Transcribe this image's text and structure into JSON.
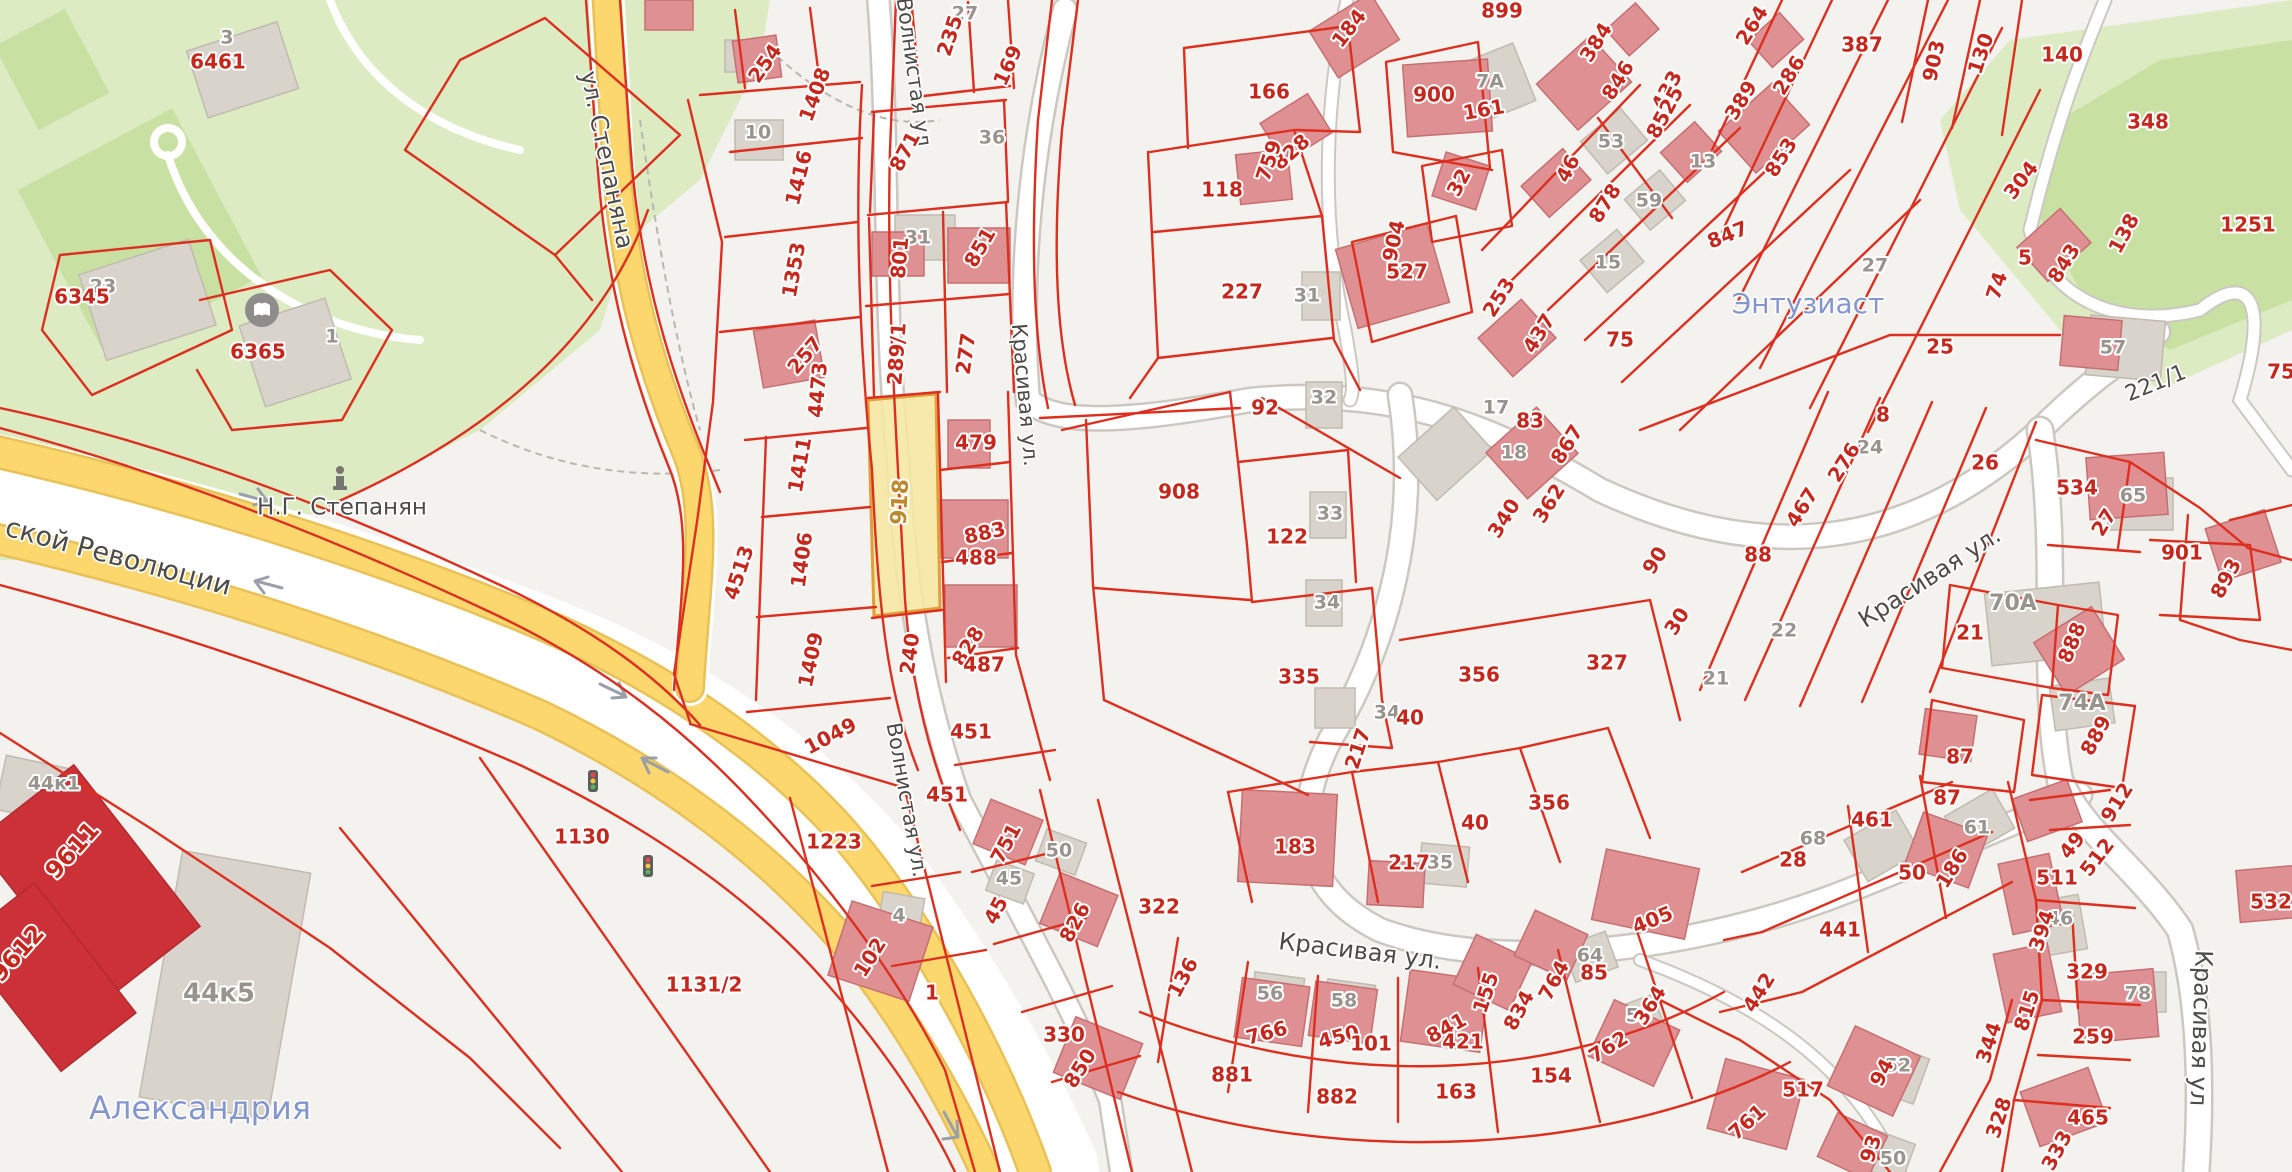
{
  "map": {
    "selected_parcel": {
      "label": "918",
      "x": 901,
      "y": 502,
      "r": -87
    },
    "colors": {
      "parcel_line": "#dd2f1f",
      "parcel_text": "#c6271d",
      "selected_fill": "#f6e7a2",
      "selected_border": "#df9f3c",
      "selected_text": "#bd8a2e",
      "road_yellow": "#fbd76e",
      "park_green": "#dcebc2",
      "building_rose": "#de9093",
      "building_gray": "#d9d4cb",
      "place_text": "#8496cd"
    },
    "street_labels": [
      [
        "ул. Степаняна",
        606,
        160,
        78,
        24
      ],
      [
        "ской Революции",
        118,
        558,
        15,
        27
      ],
      [
        "Волнистая ул",
        913,
        72,
        82,
        21
      ],
      [
        "Волнистая ул.",
        906,
        800,
        80,
        21
      ],
      [
        "Красивая ул.",
        1024,
        395,
        85,
        21
      ],
      [
        "Красивая ул.",
        1930,
        578,
        -33,
        24
      ],
      [
        "Красивая ул.",
        1360,
        952,
        7,
        24
      ],
      [
        "Красивая ул",
        2200,
        1028,
        92,
        24
      ],
      [
        "221/1",
        2156,
        384,
        -22,
        22
      ],
      [
        "Н.Г. Степанян",
        342,
        508,
        0,
        23
      ]
    ],
    "place_labels": [
      [
        "Александрия",
        200,
        1110,
        0,
        32
      ],
      [
        "Энтузиаст",
        1808,
        305,
        0,
        28
      ]
    ],
    "parcel_labels": [
      [
        "6461",
        218,
        63
      ],
      [
        "6345",
        82,
        298
      ],
      [
        "6365",
        258,
        353
      ],
      [
        "254",
        766,
        64,
        -55
      ],
      [
        "1408",
        816,
        95,
        -70
      ],
      [
        "1416",
        800,
        178,
        -76
      ],
      [
        "1353",
        795,
        270,
        -80
      ],
      [
        "257",
        806,
        356,
        -50
      ],
      [
        "4473",
        819,
        390,
        -85
      ],
      [
        "1411",
        801,
        465,
        -80
      ],
      [
        "1406",
        803,
        560,
        -82
      ],
      [
        "4513",
        740,
        573,
        -72
      ],
      [
        "1409",
        812,
        660,
        -78
      ],
      [
        "1049",
        831,
        737,
        -28
      ],
      [
        "871",
        906,
        152,
        -62
      ],
      [
        "235",
        951,
        36,
        -72
      ],
      [
        "169",
        1009,
        66,
        -66
      ],
      [
        "801",
        901,
        258,
        -85
      ],
      [
        "851",
        981,
        248,
        -60
      ],
      [
        "289/1",
        898,
        354,
        -86
      ],
      [
        "277",
        967,
        354,
        -82
      ],
      [
        "479",
        976,
        444
      ],
      [
        "883",
        985,
        534,
        -12
      ],
      [
        "488",
        976,
        559
      ],
      [
        "828",
        969,
        647,
        -58
      ],
      [
        "487",
        984,
        666
      ],
      [
        "240",
        911,
        654,
        -82
      ],
      [
        "451",
        971,
        733
      ],
      [
        "451",
        947,
        796
      ],
      [
        "1130",
        582,
        838
      ],
      [
        "1131/2",
        704,
        986
      ],
      [
        "1223",
        834,
        843
      ],
      [
        "102",
        871,
        958,
        -58
      ],
      [
        "1",
        932,
        994
      ],
      [
        "9611",
        73,
        851,
        -48,
        24
      ],
      [
        "9612",
        18,
        954,
        -48,
        24
      ],
      [
        "751",
        1007,
        844,
        -62
      ],
      [
        "45",
        997,
        911,
        -62
      ],
      [
        "826",
        1076,
        923,
        -62
      ],
      [
        "330",
        1064,
        1036
      ],
      [
        "850",
        1081,
        1069,
        -58
      ],
      [
        "322",
        1159,
        908
      ],
      [
        "136",
        1184,
        978,
        -62
      ],
      [
        "766",
        1267,
        1034,
        -15
      ],
      [
        "450",
        1339,
        1038,
        -15
      ],
      [
        "101",
        1371,
        1045
      ],
      [
        "841",
        1447,
        1029,
        -28
      ],
      [
        "421",
        1463,
        1043
      ],
      [
        "155",
        1487,
        993,
        -72
      ],
      [
        "834",
        1520,
        1011,
        -62
      ],
      [
        "764",
        1555,
        981,
        -62
      ],
      [
        "85",
        1594,
        974
      ],
      [
        "405",
        1653,
        921,
        -22
      ],
      [
        "364",
        1651,
        1006,
        -58
      ],
      [
        "762",
        1609,
        1048,
        -32
      ],
      [
        "154",
        1551,
        1077
      ],
      [
        "163",
        1456,
        1093
      ],
      [
        "881",
        1232,
        1076
      ],
      [
        "882",
        1337,
        1098
      ],
      [
        "183",
        1295,
        848
      ],
      [
        "217",
        1409,
        864
      ],
      [
        "217",
        1359,
        749,
        -72
      ],
      [
        "40",
        1410,
        719
      ],
      [
        "40",
        1475,
        824
      ],
      [
        "356",
        1479,
        676
      ],
      [
        "356",
        1549,
        804
      ],
      [
        "335",
        1299,
        678
      ],
      [
        "122",
        1287,
        538
      ],
      [
        "92",
        1265,
        409
      ],
      [
        "908",
        1179,
        493
      ],
      [
        "227",
        1242,
        293
      ],
      [
        "118",
        1222,
        191
      ],
      [
        "166",
        1269,
        93
      ],
      [
        "899",
        1502,
        12
      ],
      [
        "184",
        1350,
        29,
        -52
      ],
      [
        "828",
        1292,
        153,
        -42
      ],
      [
        "759",
        1270,
        161,
        -72
      ],
      [
        "900",
        1434,
        96
      ],
      [
        "161",
        1484,
        111,
        -10
      ],
      [
        "32",
        1460,
        183,
        -62
      ],
      [
        "904",
        1395,
        241,
        -78
      ],
      [
        "527",
        1407,
        273
      ],
      [
        "253",
        1500,
        298,
        -58
      ],
      [
        "437",
        1540,
        334,
        -58
      ],
      [
        "384",
        1597,
        43,
        -58
      ],
      [
        "846",
        1619,
        81,
        -58
      ],
      [
        "433",
        1668,
        91,
        -62
      ],
      [
        "8525",
        1666,
        113,
        -62
      ],
      [
        "46",
        1569,
        169,
        -62
      ],
      [
        "878",
        1606,
        204,
        -58
      ],
      [
        "847",
        1728,
        236,
        -22
      ],
      [
        "75",
        1620,
        341
      ],
      [
        "264",
        1753,
        26,
        -58
      ],
      [
        "286",
        1790,
        76,
        -58
      ],
      [
        "389",
        1742,
        101,
        -58
      ],
      [
        "853",
        1782,
        158,
        -58
      ],
      [
        "387",
        1862,
        46
      ],
      [
        "903",
        1935,
        61,
        -78
      ],
      [
        "130",
        1982,
        54,
        -72
      ],
      [
        "140",
        2062,
        56
      ],
      [
        "348",
        2148,
        123
      ],
      [
        "304",
        2022,
        181,
        -52
      ],
      [
        "138",
        2125,
        234,
        -62
      ],
      [
        "843",
        2065,
        264,
        -58
      ],
      [
        "5",
        2025,
        259
      ],
      [
        "74",
        1998,
        286,
        -72
      ],
      [
        "25",
        1940,
        348
      ],
      [
        "1251",
        2248,
        226
      ],
      [
        "75",
        2281,
        373
      ],
      [
        "83",
        1530,
        422
      ],
      [
        "867",
        1568,
        445,
        -58
      ],
      [
        "362",
        1550,
        504,
        -58
      ],
      [
        "340",
        1505,
        519,
        -58
      ],
      [
        "90",
        1656,
        561,
        -58
      ],
      [
        "30",
        1678,
        622,
        -58
      ],
      [
        "327",
        1607,
        664
      ],
      [
        "8",
        1883,
        416
      ],
      [
        "276",
        1845,
        463,
        -58
      ],
      [
        "26",
        1985,
        464
      ],
      [
        "467",
        1803,
        508,
        -58
      ],
      [
        "88",
        1758,
        556
      ],
      [
        "534",
        2077,
        489
      ],
      [
        "27",
        2105,
        523,
        -58
      ],
      [
        "901",
        2182,
        554
      ],
      [
        "893",
        2227,
        579,
        -62
      ],
      [
        "21",
        1970,
        634
      ],
      [
        "888",
        2073,
        643,
        -68
      ],
      [
        "889",
        2097,
        736,
        -62
      ],
      [
        "87",
        1960,
        758
      ],
      [
        "87",
        1947,
        799
      ],
      [
        "912",
        2118,
        803,
        -58
      ],
      [
        "49",
        2073,
        846,
        -52
      ],
      [
        "512",
        2098,
        858,
        -52
      ],
      [
        "511",
        2057,
        879
      ],
      [
        "394",
        2043,
        931,
        -72
      ],
      [
        "329",
        2087,
        973
      ],
      [
        "815",
        2028,
        1011,
        -72
      ],
      [
        "259",
        2093,
        1038
      ],
      [
        "344",
        1990,
        1043,
        -72
      ],
      [
        "328",
        2000,
        1118,
        -72
      ],
      [
        "465",
        2088,
        1119
      ],
      [
        "333",
        2058,
        1151,
        -62
      ],
      [
        "532",
        2271,
        903
      ],
      [
        "461",
        1872,
        821
      ],
      [
        "28",
        1793,
        861
      ],
      [
        "50",
        1912,
        874
      ],
      [
        "186",
        1953,
        869,
        -58
      ],
      [
        "441",
        1840,
        931
      ],
      [
        "442",
        1760,
        993,
        -58
      ],
      [
        "517",
        1803,
        1091
      ],
      [
        "761",
        1748,
        1123,
        -42
      ],
      [
        "94",
        1883,
        1073,
        -62
      ],
      [
        "93",
        1872,
        1149,
        -72
      ]
    ],
    "building_labels": [
      [
        "3",
        227,
        38
      ],
      [
        "23",
        103,
        287
      ],
      [
        "1",
        332,
        337
      ],
      [
        "10",
        758,
        133
      ],
      [
        "27",
        965,
        14
      ],
      [
        "36",
        992,
        138
      ],
      [
        "31",
        918,
        238
      ],
      [
        "7А",
        1490,
        82
      ],
      [
        "31",
        1307,
        296
      ],
      [
        "32",
        1324,
        398
      ],
      [
        "33",
        1330,
        514
      ],
      [
        "34",
        1327,
        603
      ],
      [
        "34",
        1387,
        713
      ],
      [
        "53",
        1611,
        142
      ],
      [
        "13",
        1703,
        162
      ],
      [
        "59",
        1649,
        201
      ],
      [
        "15",
        1608,
        263
      ],
      [
        "57",
        2113,
        348
      ],
      [
        "65",
        2133,
        496
      ],
      [
        "70А",
        2013,
        604,
        0,
        22
      ],
      [
        "22",
        1784,
        631
      ],
      [
        "21",
        1716,
        679
      ],
      [
        "74А",
        2082,
        704,
        0,
        22
      ],
      [
        "24",
        1870,
        448
      ],
      [
        "18",
        1514,
        453
      ],
      [
        "17",
        1496,
        408
      ],
      [
        "35",
        1440,
        863
      ],
      [
        "4",
        899,
        916
      ],
      [
        "50",
        1059,
        851
      ],
      [
        "45",
        1009,
        879
      ],
      [
        "56",
        1270,
        994
      ],
      [
        "58",
        1344,
        1001
      ],
      [
        "64",
        1590,
        956
      ],
      [
        "53",
        1639,
        1016
      ],
      [
        "68",
        1813,
        839
      ],
      [
        "61",
        1977,
        828
      ],
      [
        "52",
        1898,
        1066
      ],
      [
        "50",
        1893,
        1159
      ],
      [
        "46",
        2060,
        919
      ],
      [
        "78",
        2138,
        994
      ],
      [
        "44к1",
        54,
        784
      ],
      [
        "44к5",
        219,
        994,
        0,
        26
      ],
      [
        "27",
        1875,
        266
      ]
    ],
    "icons": [
      [
        "library-icon",
        262,
        310
      ],
      [
        "monument-icon",
        340,
        478
      ],
      [
        "traffic-light-icon",
        593,
        781
      ],
      [
        "traffic-light-icon",
        648,
        866
      ]
    ]
  }
}
